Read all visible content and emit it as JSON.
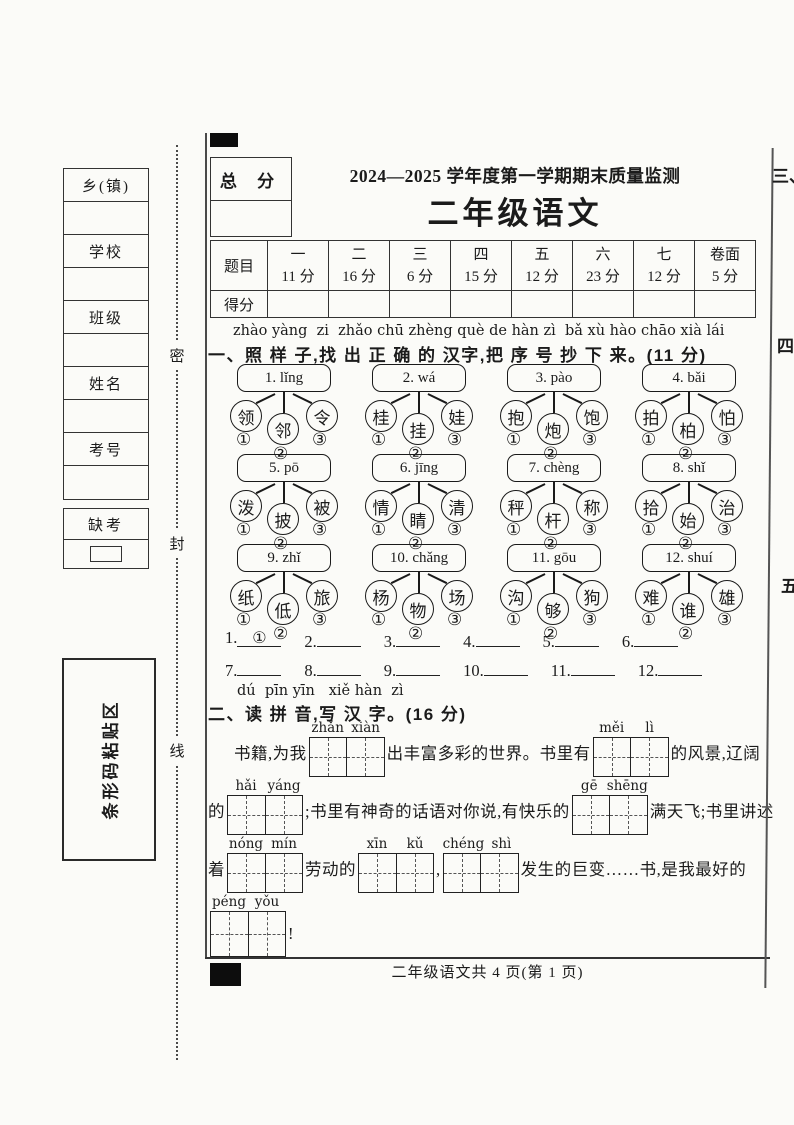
{
  "header": {
    "total_score_label": "总 分",
    "title_line1": "2024—2025 学年度第一学期期末质量监测",
    "title_line2": "二年级语文"
  },
  "score_table": {
    "corner_label": "题目",
    "score_row_label": "得分",
    "columns": [
      {
        "name": "一",
        "points": "11 分"
      },
      {
        "name": "二",
        "points": "16 分"
      },
      {
        "name": "三",
        "points": "6 分"
      },
      {
        "name": "四",
        "points": "15 分"
      },
      {
        "name": "五",
        "points": "12 分"
      },
      {
        "name": "六",
        "points": "23 分"
      },
      {
        "name": "七",
        "points": "12 分"
      },
      {
        "name": "卷面",
        "points": "5 分"
      }
    ]
  },
  "sidebar": {
    "fields": [
      "乡(镇)",
      "学校",
      "班级",
      "姓名",
      "考号"
    ],
    "absent_label": "缺考",
    "barcode_label": "条形码粘贴区",
    "seal_chars": [
      "密",
      "封",
      "线"
    ]
  },
  "section1": {
    "pinyin": "zhào yàng  zi  zhǎo chū zhèng què de hàn zì  bǎ xù hào chāo xià lái",
    "title": "一、照 样 子,找 出 正 确 的 汉字,把 序 号 抄 下 来。(11 分)",
    "option_marks": [
      "①",
      "②",
      "③"
    ],
    "groups": [
      {
        "label": "1. lǐng",
        "options": [
          "领",
          "邻",
          "令"
        ]
      },
      {
        "label": "2. wá",
        "options": [
          "桂",
          "挂",
          "娃"
        ]
      },
      {
        "label": "3. pào",
        "options": [
          "抱",
          "炮",
          "饱"
        ]
      },
      {
        "label": "4. bǎi",
        "options": [
          "拍",
          "柏",
          "怕"
        ]
      },
      {
        "label": "5. pō",
        "options": [
          "泼",
          "披",
          "被"
        ]
      },
      {
        "label": "6. jīng",
        "options": [
          "情",
          "睛",
          "清"
        ]
      },
      {
        "label": "7. chèng",
        "options": [
          "秤",
          "杆",
          "称"
        ]
      },
      {
        "label": "8. shǐ",
        "options": [
          "拾",
          "始",
          "治"
        ]
      },
      {
        "label": "9. zhǐ",
        "options": [
          "纸",
          "低",
          "旅"
        ]
      },
      {
        "label": "10. chǎng",
        "options": [
          "杨",
          "物",
          "场"
        ]
      },
      {
        "label": "11. gōu",
        "options": [
          "沟",
          "够",
          "狗"
        ]
      },
      {
        "label": "12. shuí",
        "options": [
          "难",
          "谁",
          "雄"
        ]
      }
    ],
    "answers": [
      {
        "no": "1.",
        "value": "①"
      },
      {
        "no": "2.",
        "value": ""
      },
      {
        "no": "3.",
        "value": ""
      },
      {
        "no": "4.",
        "value": ""
      },
      {
        "no": "5.",
        "value": ""
      },
      {
        "no": "6.",
        "value": ""
      },
      {
        "no": "7.",
        "value": ""
      },
      {
        "no": "8.",
        "value": ""
      },
      {
        "no": "9.",
        "value": ""
      },
      {
        "no": "10.",
        "value": ""
      },
      {
        "no": "11.",
        "value": ""
      },
      {
        "no": "12.",
        "value": ""
      }
    ]
  },
  "section2": {
    "pinyin": "dú  pīn yīn   xiě hàn  zì",
    "title": "二、读 拼 音,写 汉 字。(16 分)",
    "line1": {
      "t1": "书籍,为我",
      "box1": {
        "p1": "zhǎn",
        "p2": "xiàn"
      },
      "t2": "出丰富多彩的世界。书里有",
      "box2": {
        "p1": "měi",
        "p2": "lì"
      },
      "t3": "的风景,辽阔"
    },
    "line2": {
      "t1": "的",
      "box1": {
        "p1": "hǎi",
        "p2": "yáng"
      },
      "t2": ";书里有神奇的话语对你说,有快乐的",
      "box2": {
        "p1": "gē",
        "p2": "shēng"
      },
      "t3": "满天飞;书里讲述"
    },
    "line3": {
      "t1": "着",
      "box1": {
        "p1": "nóng",
        "p2": "mín"
      },
      "t2": "劳动的",
      "box2": {
        "p1": "xīn",
        "p2": "kǔ"
      },
      "t3": ",",
      "box3": {
        "p1": "chéng",
        "p2": "shì"
      },
      "t4": "发生的巨变……书,是我最好的"
    },
    "line4": {
      "box1": {
        "p1": "péng",
        "p2": "yǒu"
      },
      "t1": "!"
    }
  },
  "footer": {
    "text": "二年级语文共 4 页(第 1 页)"
  },
  "page2_edge": {
    "section_numbers": [
      "三、",
      "四",
      "五"
    ]
  }
}
